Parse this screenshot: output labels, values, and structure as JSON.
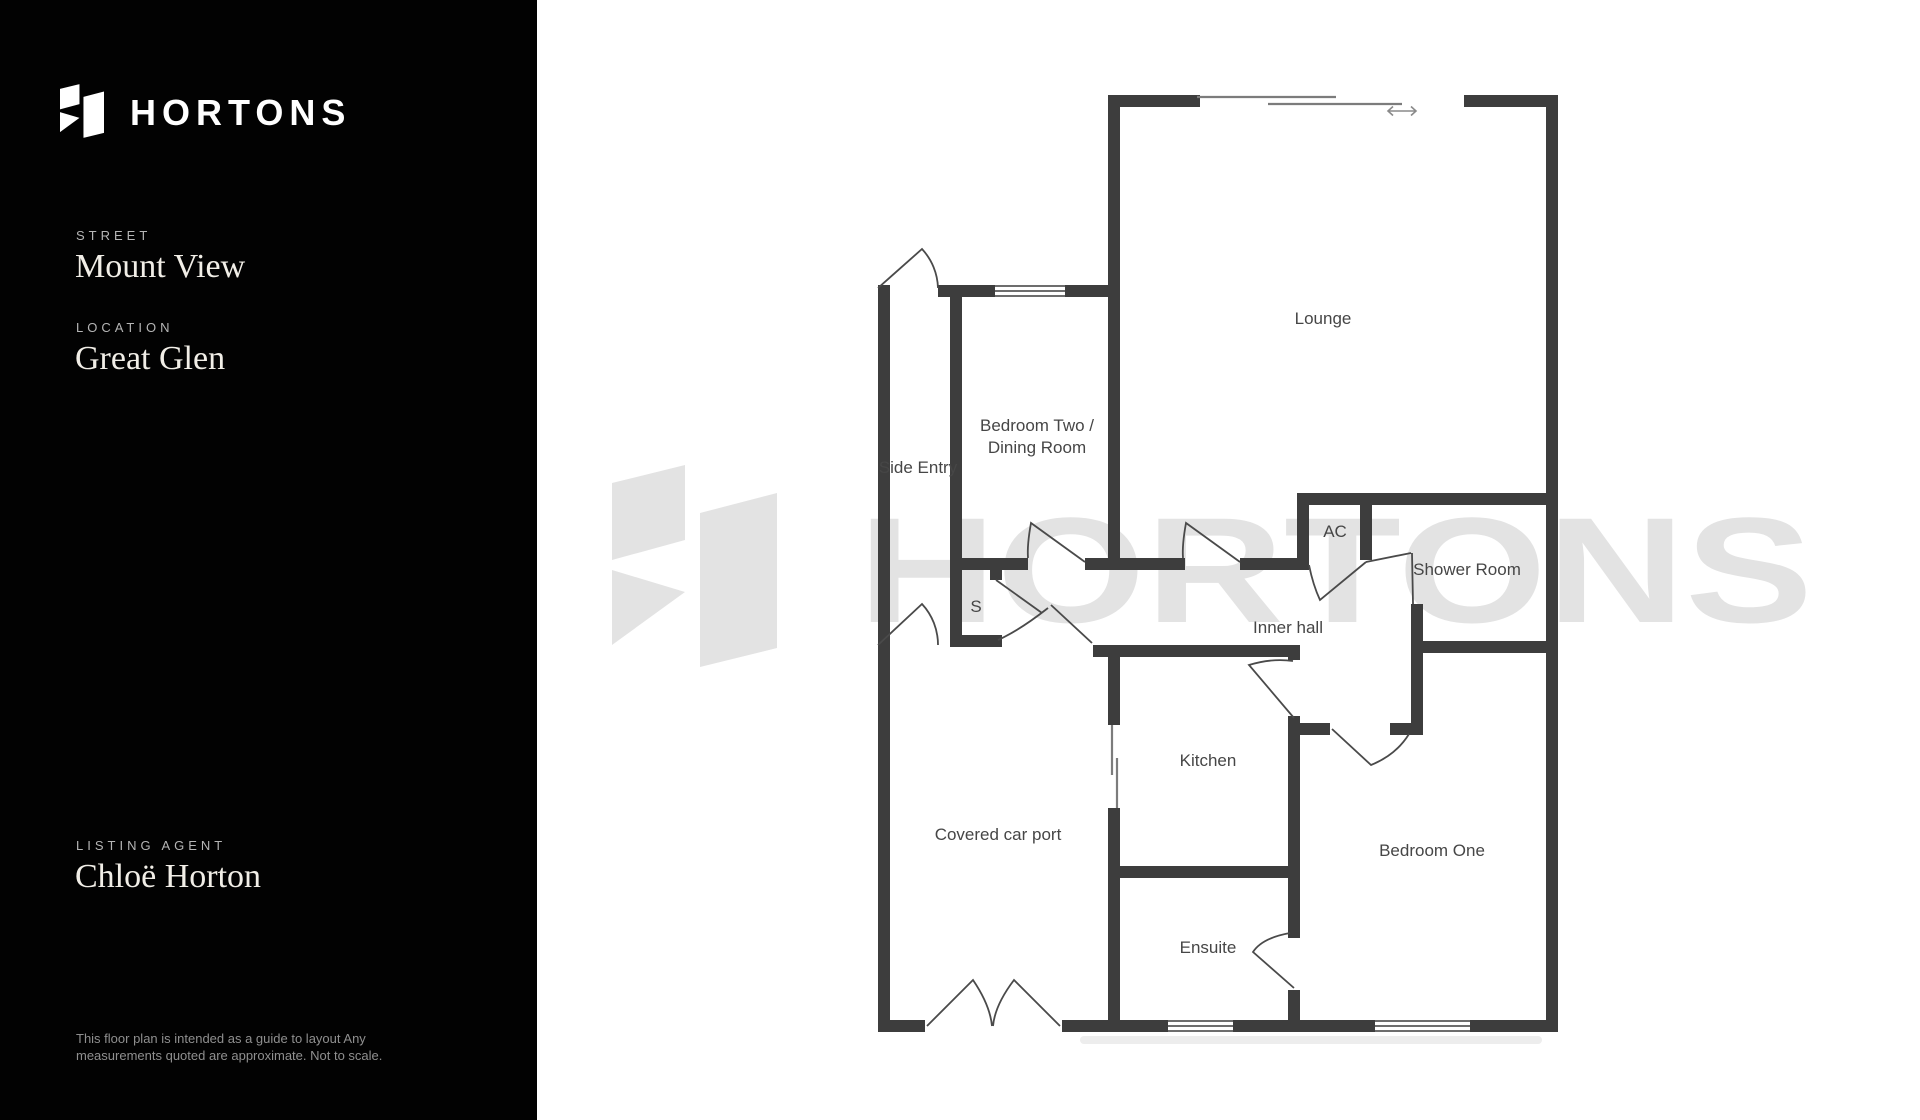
{
  "sidebar": {
    "brand": "HORTONS",
    "street_label": "STREET",
    "street_value": "Mount View",
    "location_label": "LOCATION",
    "location_value": "Great Glen",
    "agent_label": "LISTING AGENT",
    "agent_value": "Chloë Horton",
    "disclaimer_line1": "This floor plan is intended  as a guide to layout Any",
    "disclaimer_line2": "measurements quoted are approximate. Not to scale."
  },
  "floorplan": {
    "watermark_text": "HORTONS",
    "rooms": [
      {
        "name": "lounge",
        "label": "Lounge"
      },
      {
        "name": "bedroom-two-dining",
        "line1": "Bedroom Two /",
        "line2": "Dining Room"
      },
      {
        "name": "side-entry",
        "label": "Side Entry"
      },
      {
        "name": "storage-cupboard",
        "label": "S"
      },
      {
        "name": "airing-cupboard",
        "label": "AC"
      },
      {
        "name": "shower-room",
        "label": "Shower Room"
      },
      {
        "name": "inner-hall",
        "label": "Inner hall"
      },
      {
        "name": "kitchen",
        "label": "Kitchen"
      },
      {
        "name": "covered-car-port",
        "label": "Covered car port"
      },
      {
        "name": "ensuite",
        "label": "Ensuite"
      },
      {
        "name": "bedroom-one",
        "label": "Bedroom One"
      }
    ],
    "colors": {
      "wall": "#3d3d3d",
      "room_label": "#464646",
      "watermark": "#e3e3e3",
      "sidebar_bg": "#020202",
      "sidebar_heading": "#b5b5b5",
      "sidebar_value": "#f1eee7"
    }
  }
}
